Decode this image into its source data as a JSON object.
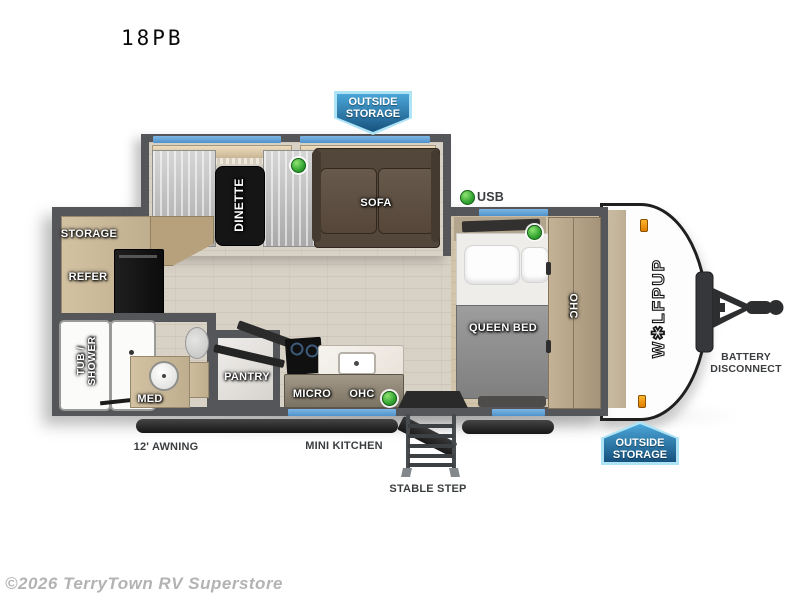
{
  "title": "18PB",
  "watermark": "©2026 TerryTown RV Superstore",
  "brand": {
    "logo": "W✱LFPUP"
  },
  "badges": {
    "top": {
      "line1": "OUTSIDE",
      "line2": "STORAGE"
    },
    "bottom": {
      "line1": "OUTSIDE",
      "line2": "STORAGE"
    }
  },
  "interior_labels": {
    "dinette": "DINETTE",
    "sofa": "SOFA",
    "storage": "STORAGE",
    "refer": "REFER",
    "tub_shower_line1": "TUB /",
    "tub_shower_line2": "SHOWER",
    "med": "MED",
    "pantry": "PANTRY",
    "micro": "MICRO",
    "ohc_kitchen": "OHC",
    "queen_bed": "QUEEN BED",
    "ohc_bedroom": "OHC"
  },
  "exterior_labels": {
    "usb": "USB",
    "awning": "12' AWNING",
    "mini_kitchen": "MINI KITCHEN",
    "stable_step": "STABLE STEP",
    "battery_line1": "BATTERY",
    "battery_line2": "DISCONNECT"
  },
  "colors": {
    "window_blue": "#5c9fd6",
    "badge_gradient_top": "#4aa6d8",
    "badge_gradient_bottom": "#16527e",
    "badge_border": "#aee3f6",
    "green_indicator": "#33a532",
    "wall_gray": "#55565a",
    "floor_wood": "#d8d1c5",
    "sofa_brown": "#53463a",
    "valance_tan": "#ddcba9",
    "bed_spread_gray": "#8f8f8f",
    "cabinet_tan": "#c9b795"
  }
}
